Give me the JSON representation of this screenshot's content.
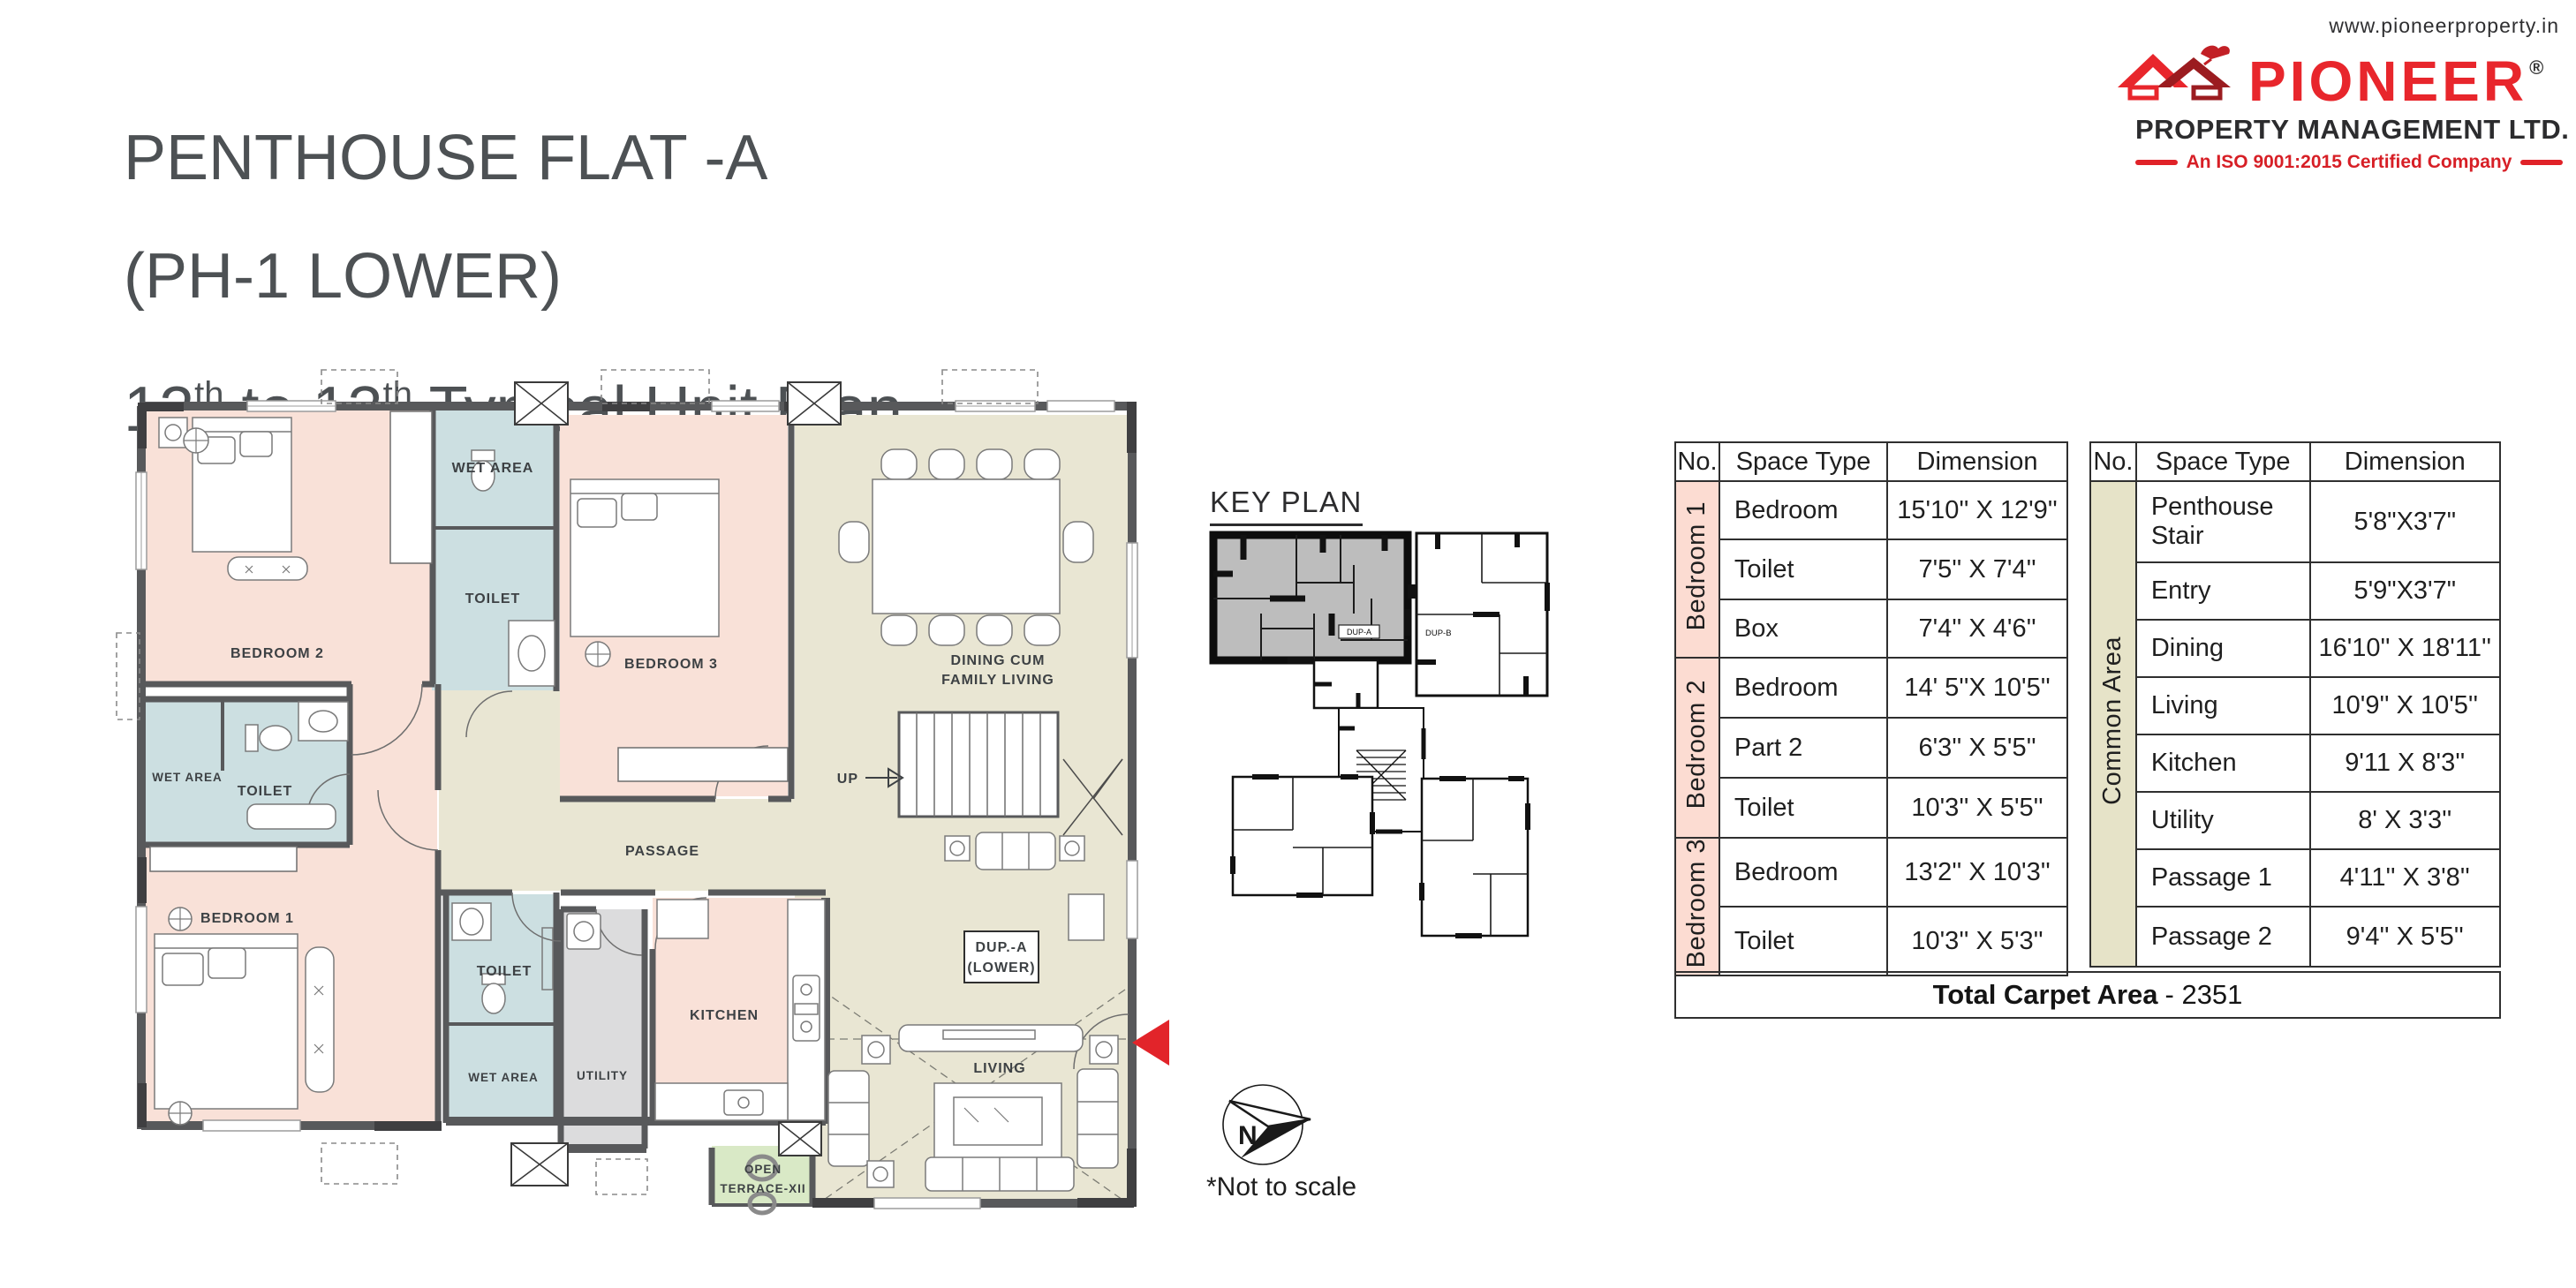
{
  "title": {
    "line1": "PENTHOUSE FLAT -A",
    "line2": "(PH-1 LOWER)",
    "line3": {
      "p1": "12",
      "sup1": "th",
      "p2": " to 13",
      "sup2": "th",
      "p3": " Typical Unit Plan"
    }
  },
  "logo": {
    "website": "www.pioneerproperty.in",
    "brand": "PIONEER",
    "registered": "®",
    "subtitle": "PROPERTY MANAGEMENT LTD.",
    "iso": "An ISO 9001:2015 Certified Company"
  },
  "floorplan": {
    "labels": {
      "bedroom1": "BEDROOM 1",
      "bedroom2": "BEDROOM 2",
      "bedroom3": "BEDROOM 3",
      "wet_area": "WET AREA",
      "toilet": "TOILET",
      "passage": "PASSAGE",
      "dining1": "DINING CUM",
      "dining2": "FAMILY LIVING",
      "up": "UP",
      "kitchen": "KITCHEN",
      "utility": "UTILITY",
      "living": "LIVING",
      "terrace1": "OPEN",
      "terrace2": "TERRACE-XII",
      "unit1": "DUP.-A",
      "unit2": "(LOWER)"
    }
  },
  "keyplan": {
    "title": "KEY PLAN",
    "unit_a": "DUP-A",
    "unit_b": "DUP-B"
  },
  "compass": {
    "n": "N",
    "note": "*Not to scale"
  },
  "tables": [
    {
      "headers": [
        "No.",
        "Space Type",
        "Dimension"
      ],
      "groups": [
        {
          "label": "Bedroom 1",
          "rows": [
            [
              "Bedroom",
              "15'10'' X 12'9''"
            ],
            [
              "Toilet",
              "7'5'' X 7'4''"
            ],
            [
              "Box",
              "7'4'' X 4'6''"
            ]
          ]
        },
        {
          "label": "Bedroom 2",
          "rows": [
            [
              "Bedroom",
              "14' 5''X 10'5''"
            ],
            [
              "Part 2",
              "6'3'' X 5'5''"
            ],
            [
              "Toilet",
              "10'3'' X 5'5''"
            ]
          ]
        },
        {
          "label": "Bedroom 3",
          "rows": [
            [
              "Bedroom",
              "13'2'' X 10'3''"
            ],
            [
              "Toilet",
              "10'3'' X 5'3''"
            ]
          ]
        }
      ]
    },
    {
      "headers": [
        "No.",
        "Space Type",
        "Dimension"
      ],
      "groups": [
        {
          "label": "Common Area",
          "rows": [
            [
              "Penthouse Stair",
              "5'8\"X3'7\""
            ],
            [
              "Entry",
              "5'9\"X3'7\""
            ],
            [
              "Dining",
              "16'10'' X 18'11''"
            ],
            [
              "Living",
              "10'9'' X 10'5''"
            ],
            [
              "Kitchen",
              "9'11 X 8'3''"
            ],
            [
              "Utility",
              "8' X 3'3''"
            ],
            [
              "Passage 1",
              "4'11'' X 3'8''"
            ],
            [
              "Passage 2",
              "9'4'' X 5'5''"
            ]
          ]
        }
      ]
    }
  ],
  "total": {
    "label": "Total Carpet Area",
    "value": "- 2351"
  }
}
